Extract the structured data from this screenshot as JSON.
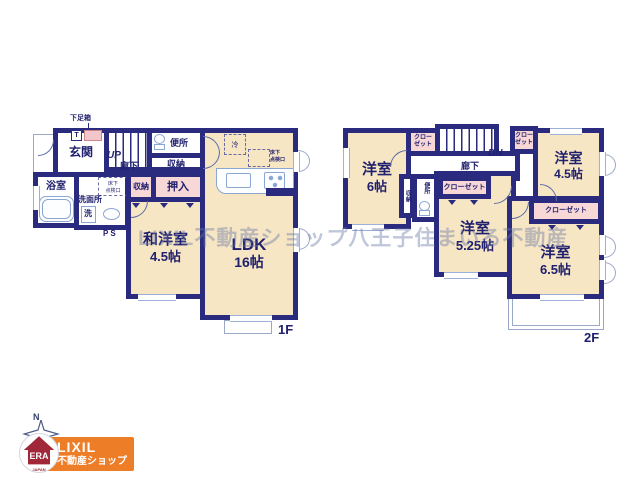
{
  "watermark": "LIXIL不動産ショップ八王子住まいる不動産",
  "colors": {
    "wall": "#2a2a7e",
    "ink": "#20206e",
    "room": "#f6e6c4",
    "closet": "#f8d7d7",
    "shoebox_pink": "#f3c6cc",
    "fixture_blue": "#8ca6d2",
    "orange": "#ee7d28",
    "era_red": "#a02838"
  },
  "f1": {
    "floor_label": "1F",
    "shoe_box_label": "下足箱",
    "t_label": "T",
    "genkan": "玄関",
    "up": "UP",
    "hallway": "廊下",
    "toilet": "便所",
    "storage_a": "収納",
    "bath": "浴室",
    "washroom": "洗面所",
    "washer": "洗",
    "ps": "PS",
    "storage_b": "収納",
    "oshiire": "押入",
    "waroom_name": "和洋室",
    "waroom_size": "4.5帖",
    "ldk_name": "LDK",
    "ldk_size": "16帖",
    "fridge": "冷"
  },
  "f2": {
    "floor_label": "2F",
    "room6_name": "洋室",
    "room6_size": "6帖",
    "room45_name": "洋室",
    "room45_size": "4.5帖",
    "room525_name": "洋室",
    "room525_size": "5.25帖",
    "room65_name": "洋室",
    "room65_size": "6.5帖",
    "closet_small_line1": "クロー",
    "closet_small_line2": "ゼット",
    "closet": "クローゼット",
    "hallway": "廊下",
    "dn": "DN",
    "storage": "収納",
    "toilet": "便所"
  },
  "shared": {
    "underfloor_line1": "床下",
    "underfloor_line2": "点検口"
  },
  "logo": {
    "north": "N",
    "era": "ERA",
    "era_country": "JAPAN",
    "brand_line1": "LIXIL",
    "brand_line2": "不動産ショップ"
  }
}
